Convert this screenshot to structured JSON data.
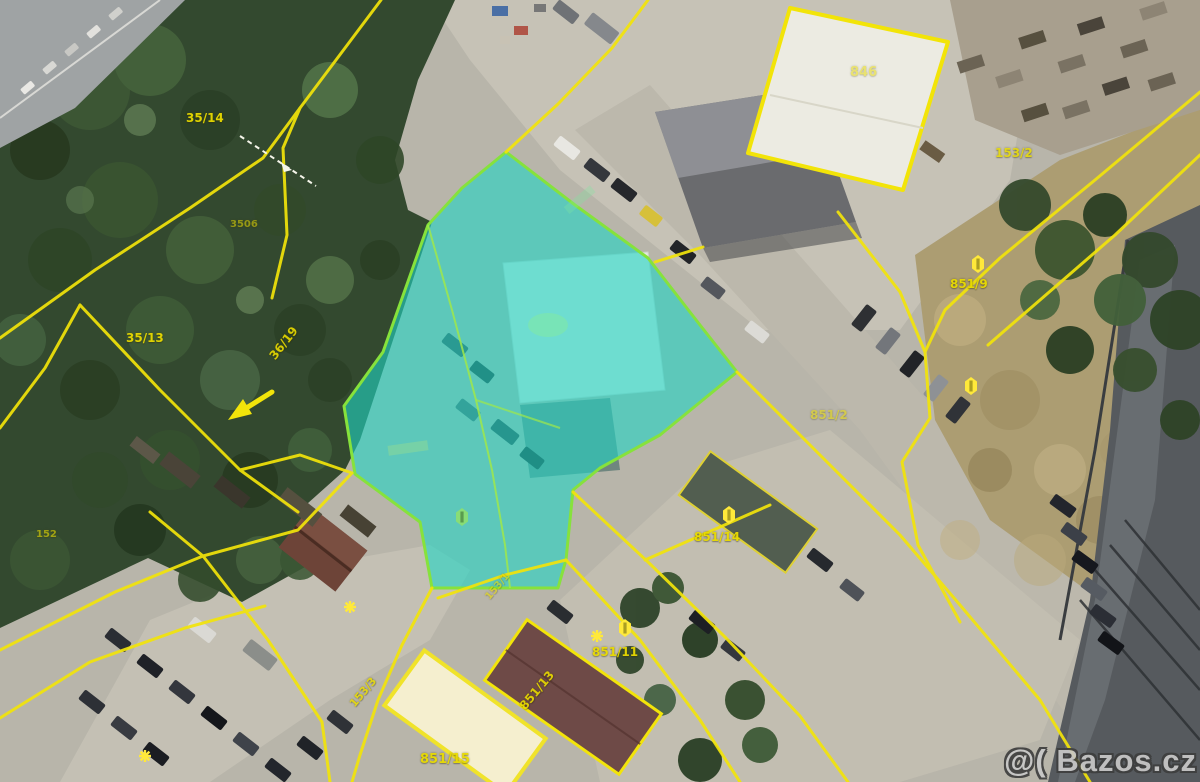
{
  "scene": {
    "description": "Aerial cadastral map photo with a highlighted parcel",
    "watermark": "@( Bazos.cz"
  },
  "palette": {
    "cadastral_yellow": "#f2e40a",
    "highlight_teal": "#20d6c4",
    "highlight_border": "#86e23c",
    "forest_green": "#33492f",
    "pavement_gray": "#c0bcb0",
    "dry_grass_tan": "#ac9d72",
    "railway_gray": "#565a5e",
    "watermark_gray": "#c8c8c8"
  },
  "map": {
    "labels": [
      {
        "text": "35/14",
        "x": 186,
        "y": 112,
        "rot": 0,
        "fs": 12,
        "op": 0.95
      },
      {
        "text": "3506",
        "x": 230,
        "y": 220,
        "rot": 0,
        "fs": 10,
        "op": 0.55
      },
      {
        "text": "35/13",
        "x": 126,
        "y": 332,
        "rot": 0,
        "fs": 12,
        "op": 0.95
      },
      {
        "text": "36/19",
        "x": 272,
        "y": 352,
        "rot": -52,
        "fs": 12,
        "op": 0.9
      },
      {
        "text": "153/2",
        "x": 995,
        "y": 147,
        "rot": 0,
        "fs": 12,
        "op": 0.85
      },
      {
        "text": "846",
        "x": 850,
        "y": 66,
        "rot": 0,
        "fs": 13,
        "op": 0.5
      },
      {
        "text": "851/9",
        "x": 950,
        "y": 278,
        "rot": 0,
        "fs": 12,
        "op": 0.95
      },
      {
        "text": "851/2",
        "x": 810,
        "y": 409,
        "rot": 0,
        "fs": 12,
        "op": 0.55
      },
      {
        "text": "851/14",
        "x": 694,
        "y": 531,
        "rot": 0,
        "fs": 12,
        "op": 0.95
      },
      {
        "text": "851/11",
        "x": 592,
        "y": 646,
        "rot": 0,
        "fs": 12,
        "op": 0.95
      },
      {
        "text": "851/13",
        "x": 522,
        "y": 702,
        "rot": -50,
        "fs": 12,
        "op": 0.9
      },
      {
        "text": "153/3",
        "x": 352,
        "y": 700,
        "rot": -50,
        "fs": 11,
        "op": 0.85
      },
      {
        "text": "153/1",
        "x": 488,
        "y": 594,
        "rot": -50,
        "fs": 10,
        "op": 0.6
      },
      {
        "text": "851/15",
        "x": 420,
        "y": 753,
        "rot": 0,
        "fs": 13,
        "op": 0.95
      },
      {
        "text": "152",
        "x": 36,
        "y": 530,
        "rot": 0,
        "fs": 10,
        "op": 0.6
      }
    ]
  }
}
